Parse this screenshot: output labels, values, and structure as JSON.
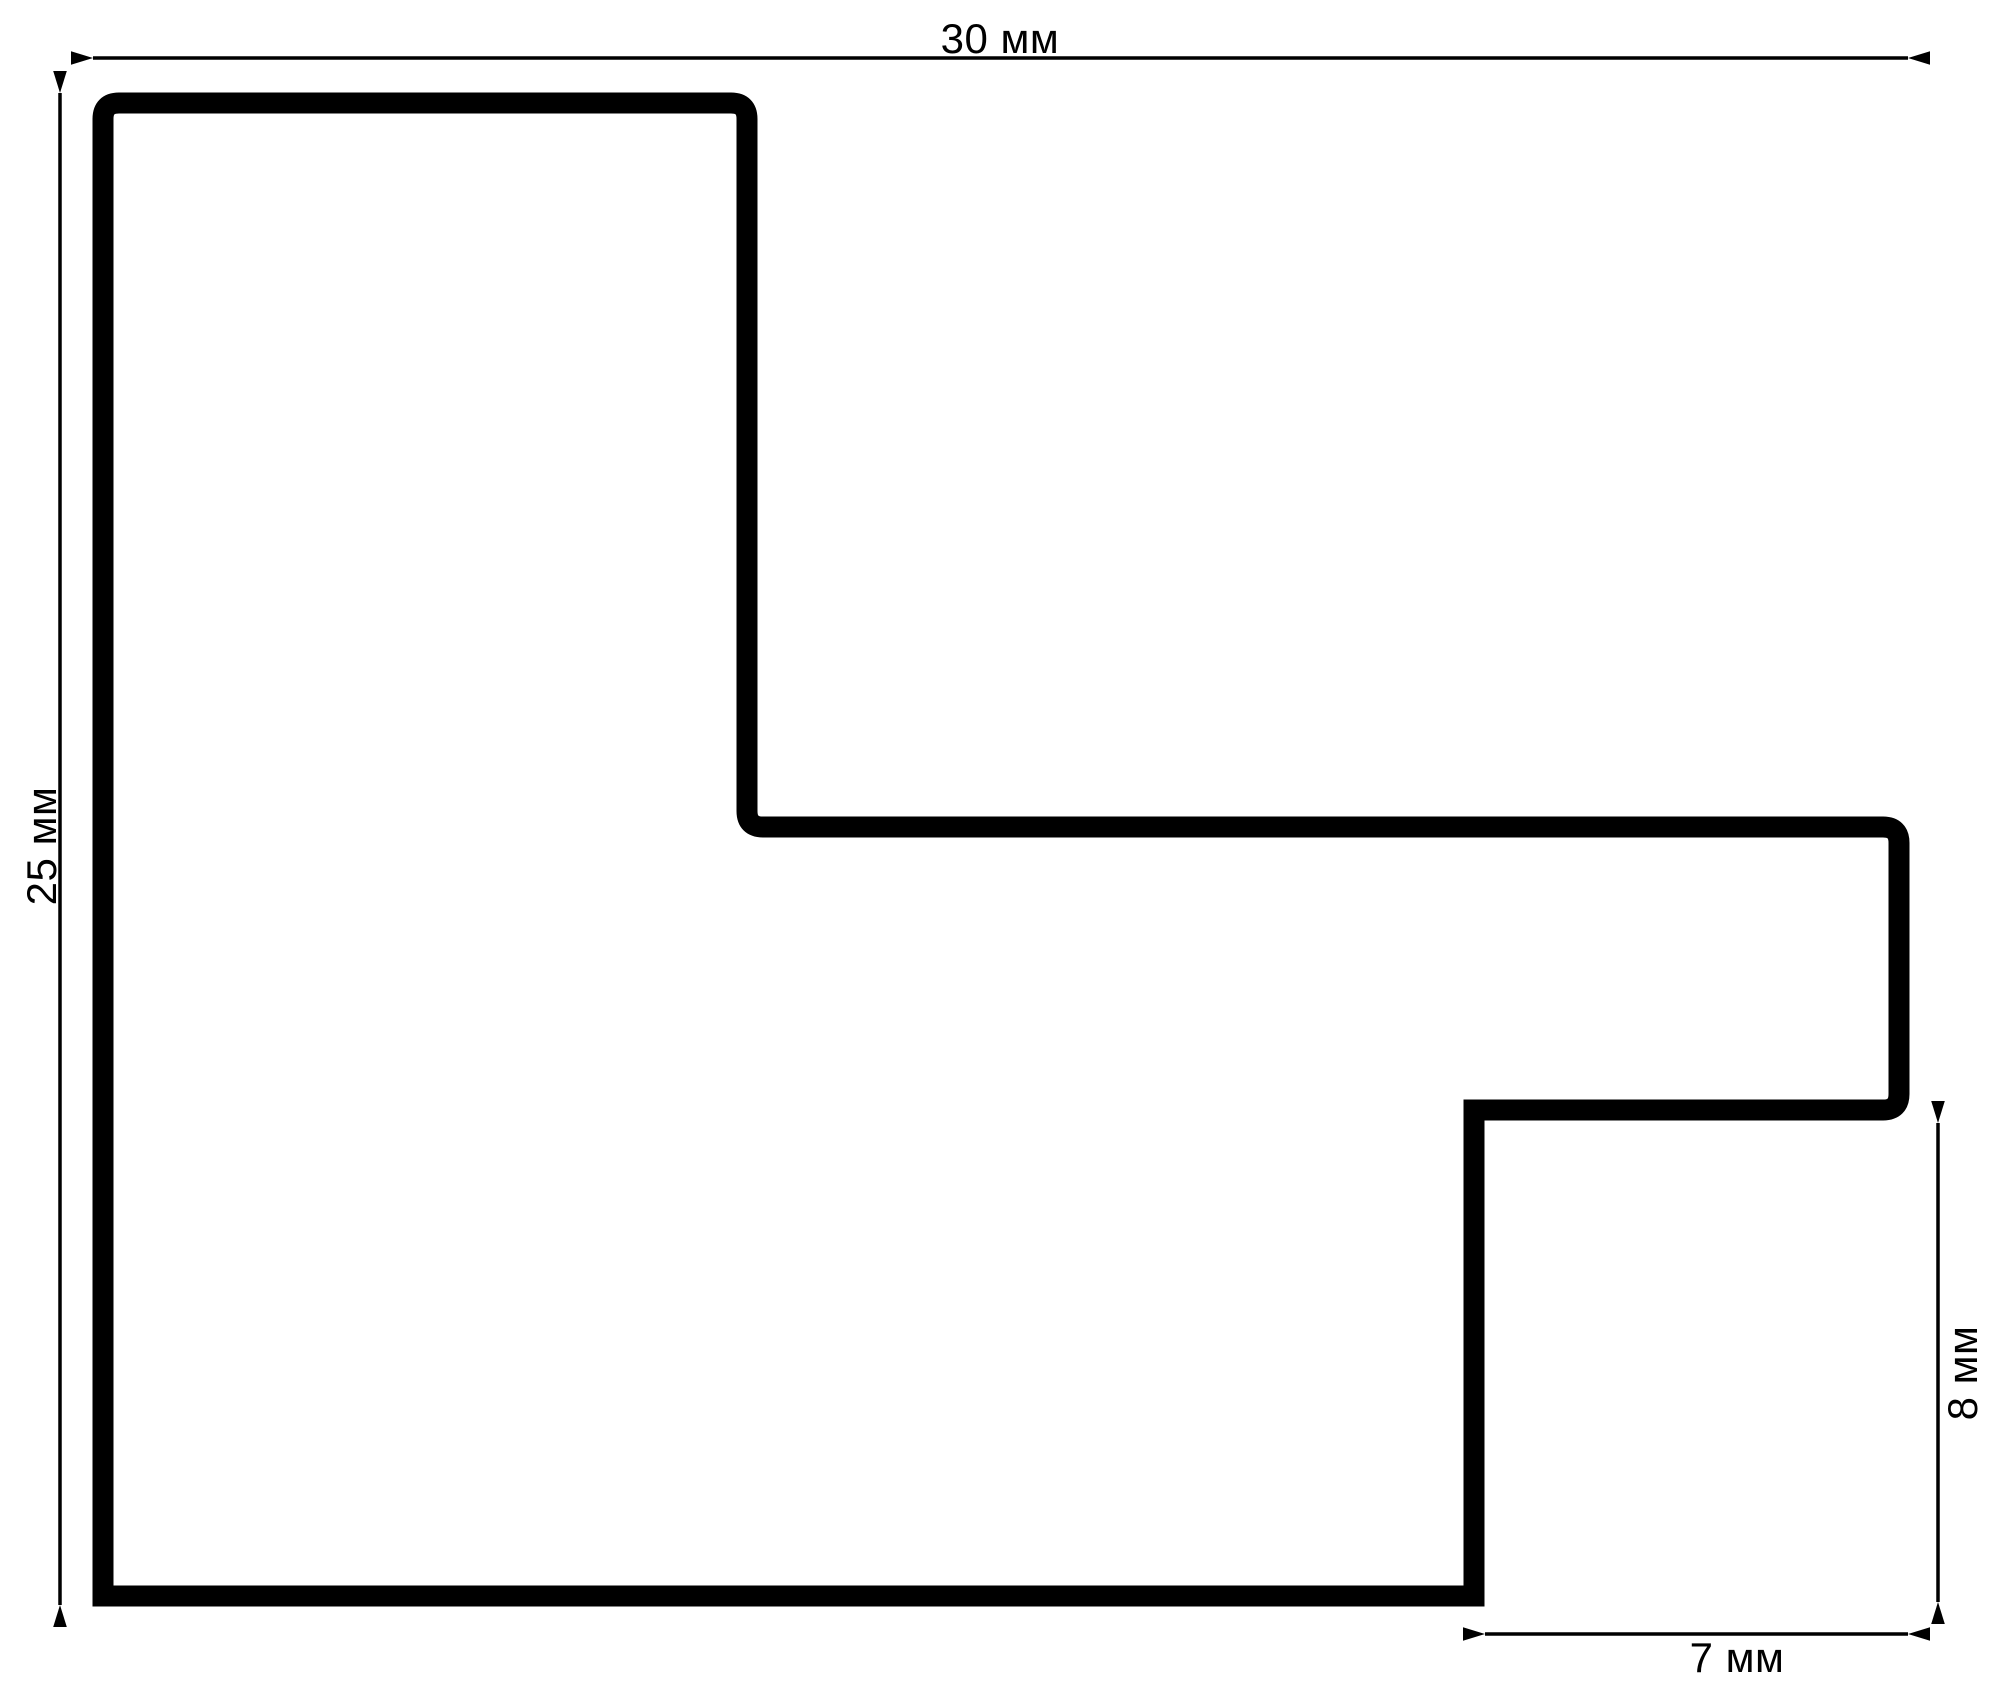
{
  "drawing": {
    "type": "profile-cross-section",
    "unit": "мм",
    "background_color": "#ffffff",
    "line_color": "#000000",
    "dimensions": {
      "total_width": {
        "value": "30",
        "unit": "мм",
        "label": "30 мм",
        "side": "top"
      },
      "total_height": {
        "value": "25",
        "unit": "мм",
        "label": "25 мм",
        "side": "left"
      },
      "step_height": {
        "value": "8",
        "unit": "мм",
        "label": "8 мм",
        "side": "right"
      },
      "step_width": {
        "value": "7",
        "unit": "мм",
        "label": "7 мм",
        "side": "bottom"
      }
    }
  }
}
